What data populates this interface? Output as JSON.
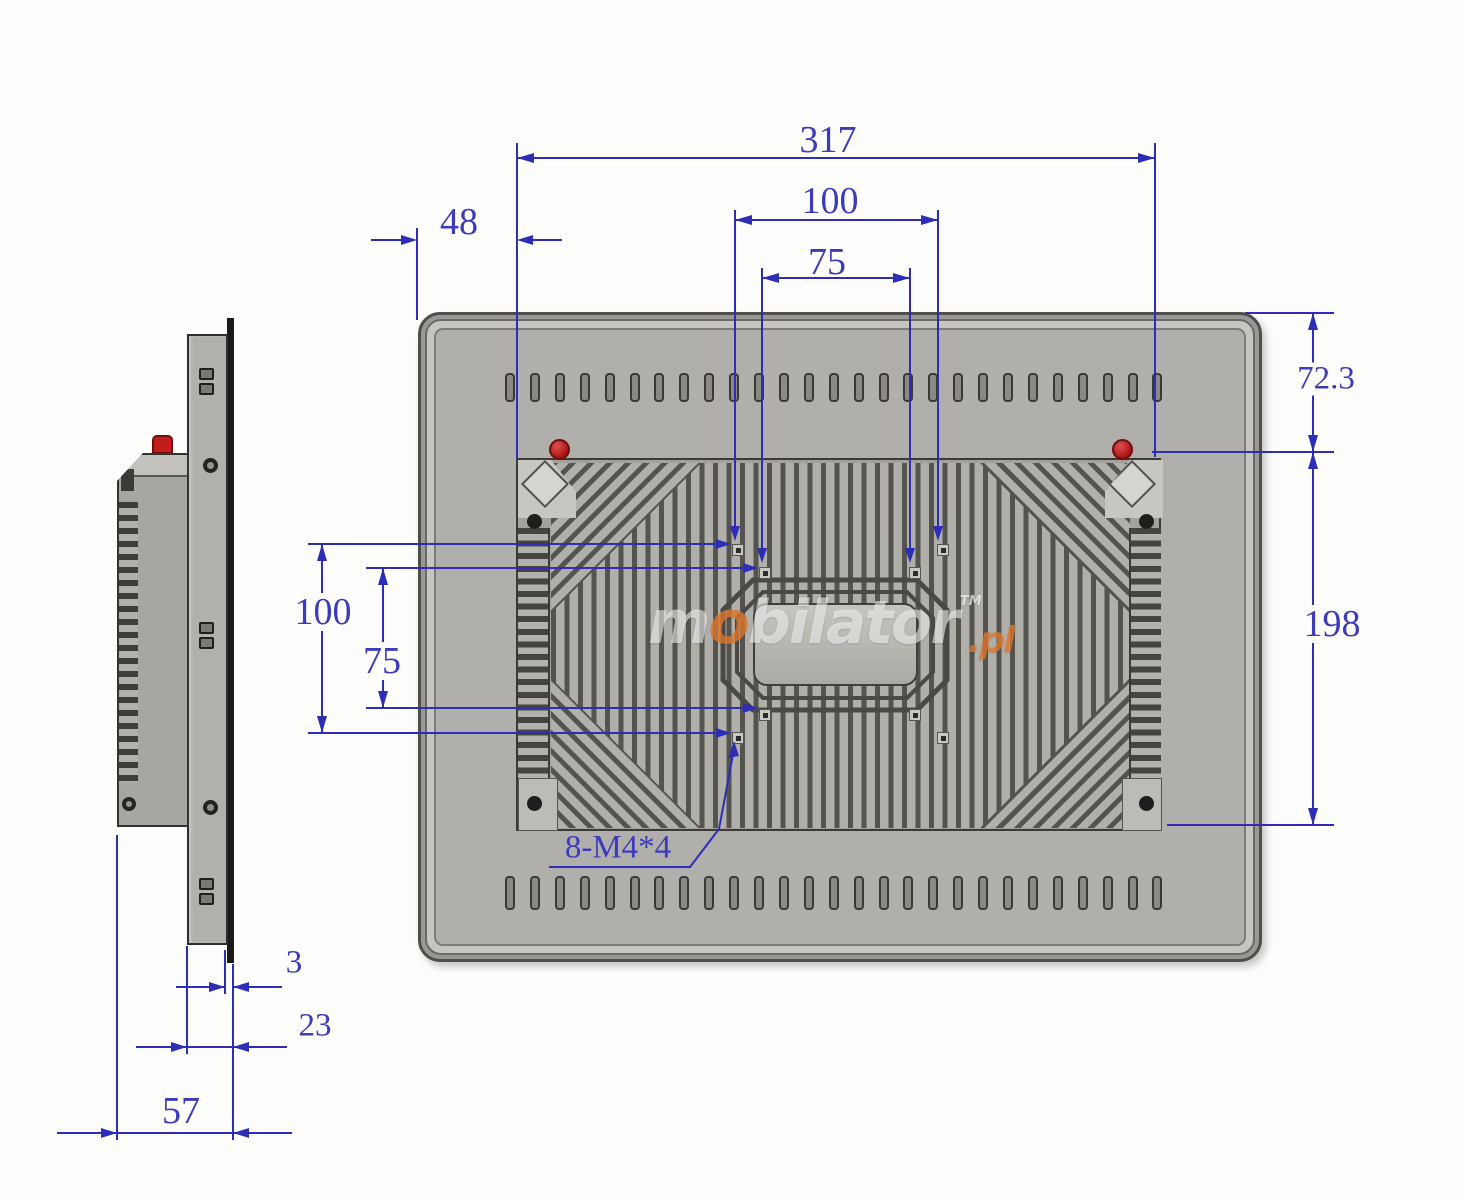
{
  "title": "Panel PC technical dimension drawing (rear view and side view)",
  "watermark": {
    "m": "m",
    "o": "o",
    "rest": "bilator",
    "tm": "TM",
    "pl": ".pl"
  },
  "dims": {
    "width_317": "317",
    "offset_48": "48",
    "vesa_100_top": "100",
    "vesa_75_top": "75",
    "height_72_3": "72.3",
    "height_198": "198",
    "vesa_100_left": "100",
    "vesa_75_left": "75",
    "screws_note": "8-M4*4",
    "glass_3": "3",
    "bezel_23": "23",
    "depth_57": "57"
  },
  "colors": {
    "dimension_blue": "#2d2db6",
    "case_gray": "#b1afab",
    "glass_black": "#1a1a19",
    "screw_red": "#c11d1d",
    "watermark_orange": "#e2782d"
  }
}
